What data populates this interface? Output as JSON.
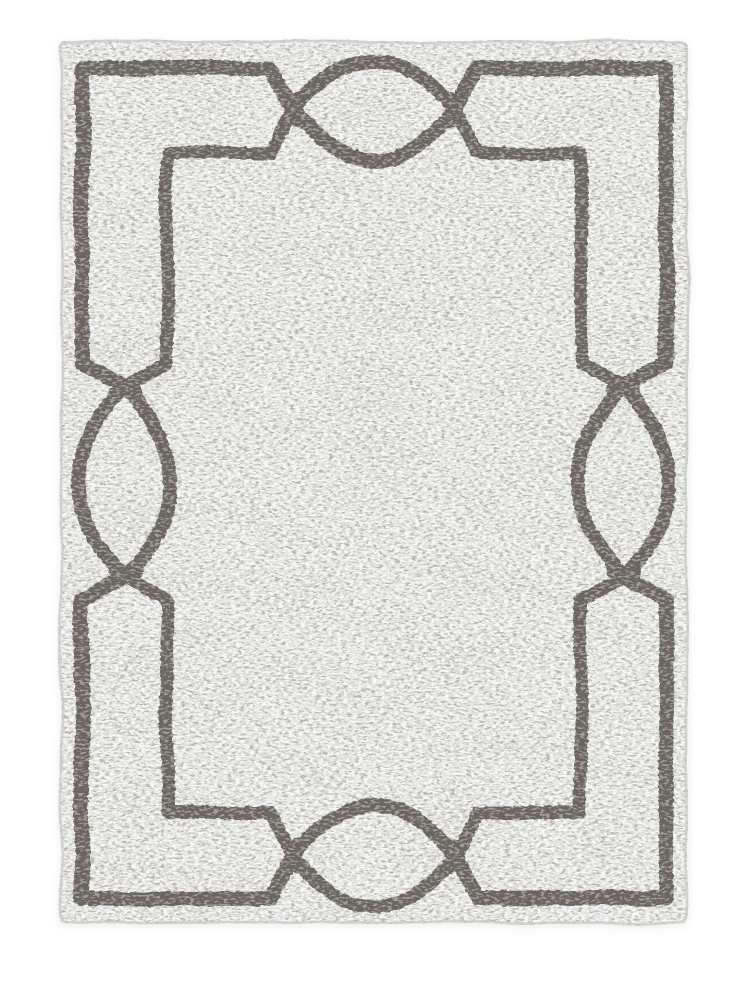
{
  "page": {
    "background_color": "#ffffff"
  },
  "product_photo": {
    "subject": "Rectangular area rug in portrait orientation photographed flat on a plain white background",
    "style": "Heathered ivory-gray hand-hooked rug with a taupe geometric fretwork border: an outer and an inner rectangular frame line that step diagonally inward to interlock with a pointed-oval (lens) motif centered on each of the four sides, the two arcs crossing in a small X at each oval tip",
    "texture": "Mottled loop-pile weave with fine horizontal flecks of warm tan and white over a pale gray field",
    "colors": {
      "field": "#e0e3e1",
      "fleck_dark": "#b2aca2",
      "fleck_light": "#fbfbfa",
      "blotch": "#c2bbae",
      "border_line": "#6c655e",
      "edge_binding": "#c8cbc8"
    },
    "motifs": {
      "frame_lines": 2,
      "side_ovals": 4,
      "oval_positions": [
        "top-center",
        "bottom-center",
        "left-center",
        "right-center"
      ]
    }
  }
}
